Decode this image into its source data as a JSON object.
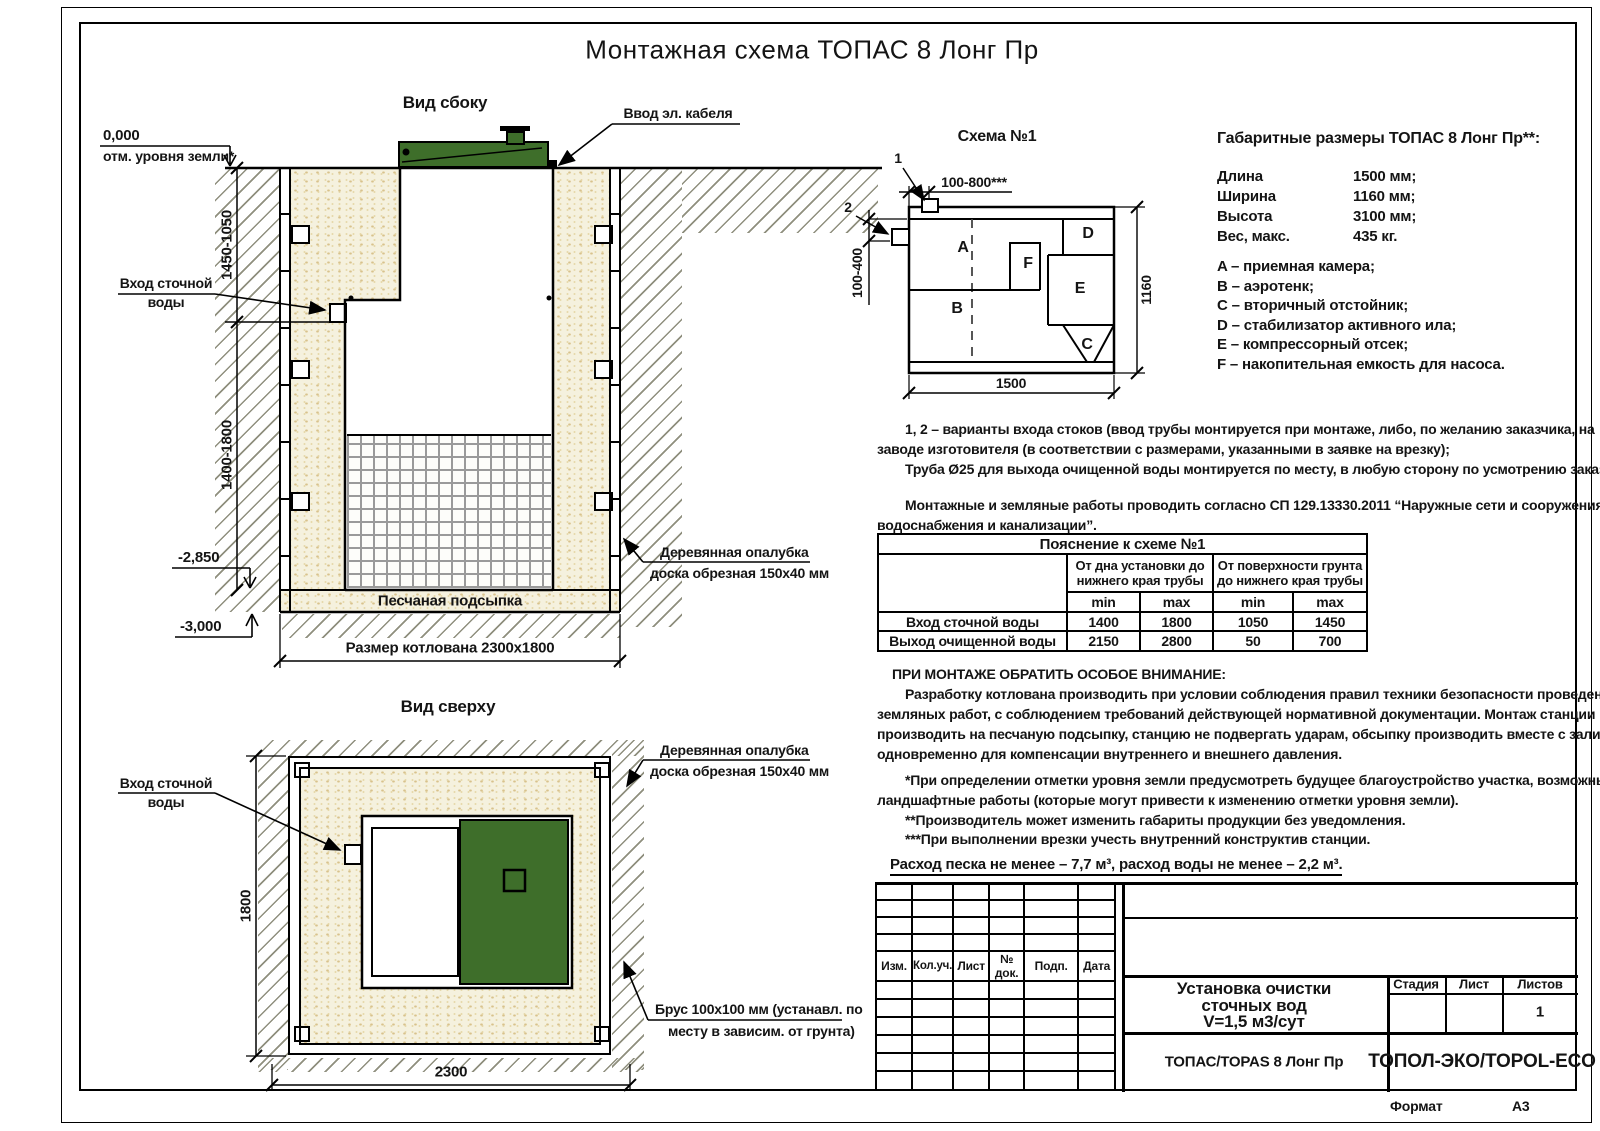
{
  "page": {
    "title": "Монтажная схема ТОПАС 8 Лонг Пр",
    "format_label": "Формат",
    "format_value": "А3"
  },
  "side_view": {
    "title": "Вид сбоку",
    "zero_mark": "0,000",
    "ground_note": "отм. уровня земли*",
    "dim_upper": "1450-1050",
    "dim_lower": "1400-1800",
    "level_mid": "-2,850",
    "level_bottom": "-3,000",
    "inlet_line1": "Вход сточной",
    "inlet_line2": "воды",
    "cable_label": "Ввод эл. кабеля",
    "bedding_label": "Песчаная подсыпка",
    "formwork_line1": "Деревянная опалубка",
    "formwork_line2": "доска обрезная 150x40 мм",
    "pit_dim_label": "Размер котлована 2300x1800"
  },
  "top_view": {
    "title": "Вид сверху",
    "inlet_line1": "Вход сточной",
    "inlet_line2": "воды",
    "dim_height": "1800",
    "dim_width": "2300",
    "formwork_line1": "Деревянная опалубка",
    "formwork_line2": "доска обрезная 150x40 мм",
    "beam_line1": "Брус 100x100 мм (устанавл. по",
    "beam_line2": "месту в зависим. от грунта)"
  },
  "schema": {
    "title": "Схема №1",
    "marker1": "1",
    "marker2": "2",
    "dim_top": "100-800***",
    "dim_left": "100-400",
    "dim_right": "1160",
    "dim_bottom": "1500",
    "comp_a": "A",
    "comp_b": "B",
    "comp_c": "C",
    "comp_d": "D",
    "comp_e": "E",
    "comp_f": "F"
  },
  "specs": {
    "heading": "Габаритные размеры ТОПАС 8 Лонг Пр**:",
    "rows": [
      {
        "label": "Длина",
        "value": "1500 мм;"
      },
      {
        "label": "Ширина",
        "value": "1160 мм;"
      },
      {
        "label": "Высота",
        "value": "3100 мм;"
      },
      {
        "label": "Вес, макс.",
        "value": "435 кг."
      }
    ],
    "legend": [
      "A – приемная камера;",
      "B – аэротенк;",
      "C – вторичный отстойник;",
      "D – стабилизатор активного ила;",
      "E – компрессорный отсек;",
      "F – накопительная емкость для насоса."
    ]
  },
  "notes": {
    "p1_l1": "1, 2 – варианты входа  стоков (ввод трубы монтируется при монтаже, либо, по желанию заказчика, на",
    "p1_l2": "заводе изготовителя (в соответствии с размерами, указанными в заявке на врезку);",
    "p1_l3": "Труба Ø25 для выхода очищенной воды монтируется по месту, в любую сторону по усмотрению заказчика.",
    "p2_l1": "Монтажные и земляные работы проводить согласно СП 129.13330.2011 “Наружные сети и сооружения",
    "p2_l2": "водоснабжения и канализации”."
  },
  "table": {
    "title": "Пояснение к схеме №1",
    "group1_l1": "От дна установки до",
    "group1_l2": "нижнего края трубы",
    "group2_l1": "От поверхности грунта",
    "group2_l2": "до нижнего края трубы",
    "min": "min",
    "max": "max",
    "rows": [
      {
        "label": "Вход сточной воды",
        "v1": "1400",
        "v2": "1800",
        "v3": "1050",
        "v4": "1450"
      },
      {
        "label": "Выход очищенной воды",
        "v1": "2150",
        "v2": "2800",
        "v3": "50",
        "v4": "700"
      }
    ]
  },
  "attention": {
    "heading": "ПРИ МОНТАЖЕ ОБРАТИТЬ ОСОБОЕ ВНИМАНИЕ:",
    "l1": "Разработку котлована производить при условии соблюдения правил техники безопасности проведения",
    "l2": "земляных работ, с соблюдением требований действующей нормативной документации. Монтаж станции",
    "l3": "производить на песчаную подсыпку, станцию не подвергать ударам, обсыпку производить вместе с заливкой",
    "l4": "одновременно для компенсации внутреннего и внешнего давления.",
    "f1": "*При определении отметки уровня земли предусмотреть будущее благоустройство участка, возможные",
    "f2": "ландшафтные работы (которые могут привести к изменению отметки уровня земли).",
    "f3": "**Производитель может изменить габариты продукции без уведомления.",
    "f4": "***При выполнении врезки учесть внутренний конструктив станции.",
    "consumption": "Расход песка не менее – 7,7 м³, расход воды не менее – 2,2 м³."
  },
  "title_block": {
    "rev_headers": [
      "Изм.",
      "Кол.уч.",
      "Лист",
      "№ док.",
      "Подп.",
      "Дата"
    ],
    "doc_line1": "Установка очистки",
    "doc_line2": "сточных вод",
    "doc_line3": "V=1,5 м3/сут",
    "stage": "Стадия",
    "sheet": "Лист",
    "sheets": "Листов",
    "sheets_value": "1",
    "model": "ТОПАС/TOPAS 8 Лонг Пр",
    "company": "ТОПОЛ-ЭКО/TOPOL-ECO"
  },
  "colors": {
    "green": "#3e6e2a",
    "sand": "#f5f1de"
  }
}
